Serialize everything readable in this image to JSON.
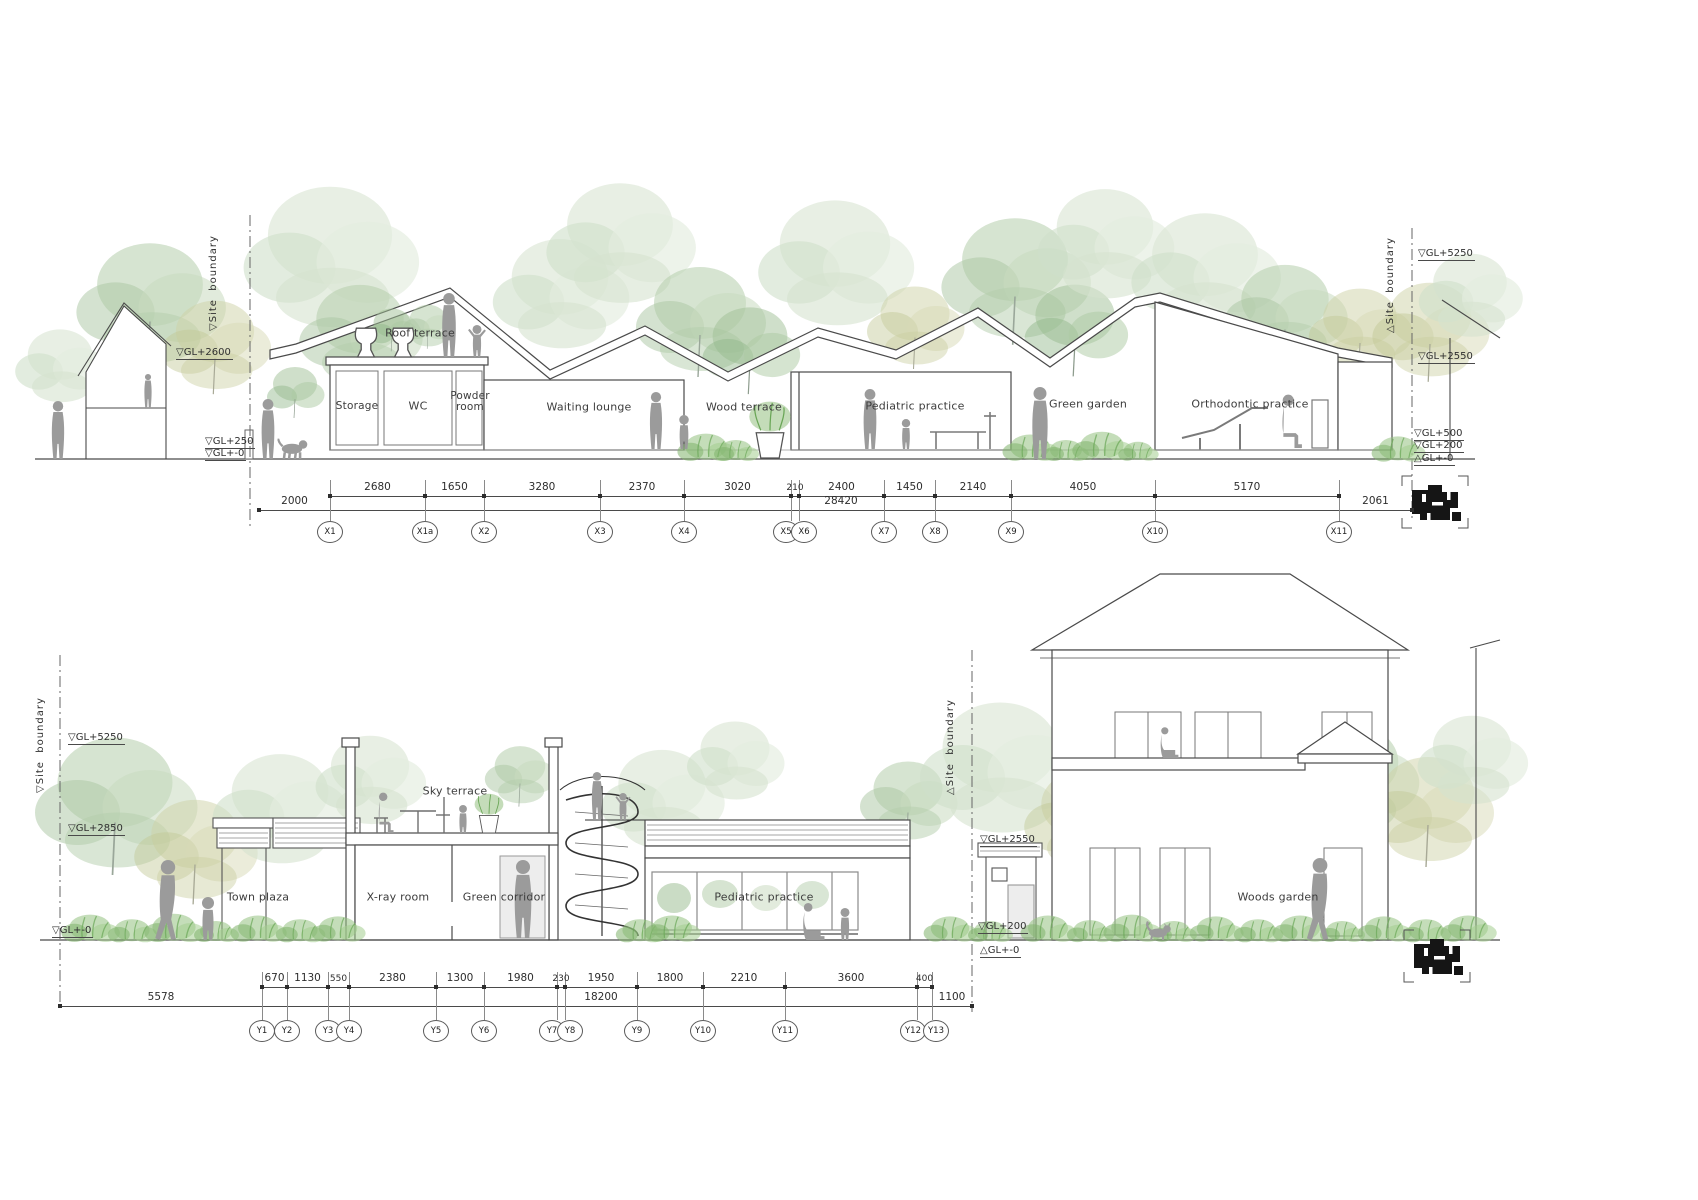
{
  "sheet": {
    "title": "Clinic sections"
  },
  "palette": {
    "line": "#4a4a4a",
    "silhouette": "#9b9b9b",
    "tree_green": "#b4cdab",
    "tree_olive": "#cdd1a6",
    "tree_pale": "#dbe7d5",
    "plant_green": "#8fc17b"
  },
  "top_section": {
    "boundary_left_label": "▽Site  boundary",
    "boundary_right_label": "△Site  boundary",
    "levels_left": [
      "▽GL+2600",
      "▽GL+250",
      "▽GL+-0"
    ],
    "levels_right": [
      "▽GL+5250",
      "▽GL+2550",
      "▽GL+500",
      "▽GL+200",
      "△GL+-0"
    ],
    "rooms": [
      "Roof terrace",
      "Storage",
      "WC",
      "Powder room",
      "Waiting lounge",
      "Wood terrace",
      "Pediatric practice",
      "Green garden",
      "Orthodontic practice"
    ],
    "dims": {
      "left": "2000",
      "segments": [
        "2680",
        "1650",
        "3280",
        "2370",
        "3020",
        "210",
        "2400",
        "1450",
        "2140",
        "4050",
        "5170"
      ],
      "right": "2061",
      "total": "28420"
    },
    "grid": [
      "X1",
      "X1a",
      "X2",
      "X3",
      "X4",
      "X5",
      "X6",
      "X7",
      "X8",
      "X9",
      "X10",
      "X11"
    ]
  },
  "bottom_section": {
    "boundary_left_label": "▽Site  boundary",
    "boundary_right_label": "△Site  boundary",
    "levels_left": [
      "▽GL+5250",
      "▽GL+2850",
      "▽GL+-0"
    ],
    "levels_right": [
      "▽GL+2550",
      "▽GL+200",
      "△GL+-0"
    ],
    "rooms": [
      "Town plaza",
      "Sky terrace",
      "X-ray room",
      "Green corridor",
      "Pediatric practice",
      "Woods garden"
    ],
    "dims": {
      "left": "5578",
      "segments": [
        "670",
        "1130",
        "550",
        "2380",
        "1300",
        "1980",
        "230",
        "1950",
        "1800",
        "2210",
        "3600",
        "400"
      ],
      "right": "1100",
      "total": "18200"
    },
    "grid": [
      "Y1",
      "Y2",
      "Y3",
      "Y4",
      "Y5",
      "Y6",
      "Y7",
      "Y8",
      "Y9",
      "Y10",
      "Y11",
      "Y12",
      "Y13"
    ]
  }
}
